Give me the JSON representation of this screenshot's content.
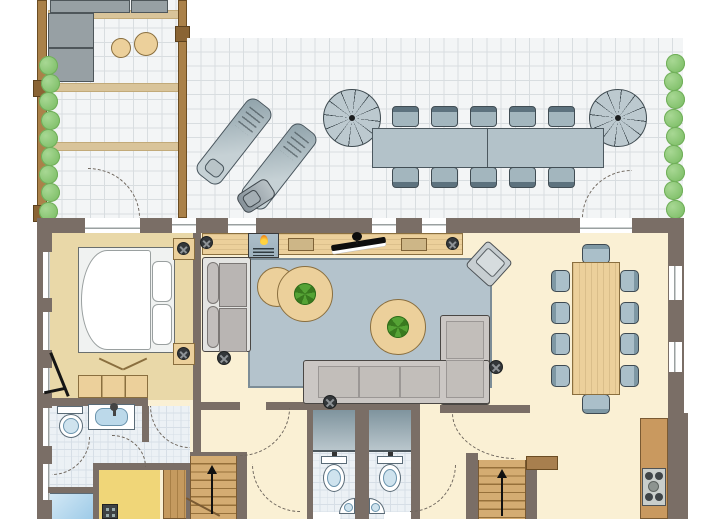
{
  "plan": {
    "type": "floor-plan",
    "view": "top-down",
    "text_labels": [],
    "levels_shown": 1
  },
  "palette": {
    "wall": "#7a6e66",
    "tile": "#f3f5f6",
    "tile_line": "#d8dde0",
    "floor_cream": "#faf0d4",
    "floor_bedroom": "#e9d8a8",
    "floor_bath": "#ecf1f5",
    "bath_line": "#d6dee6",
    "beam": "#d9c49a",
    "fence": "#aa8149",
    "fence_dark": "#6b4c22",
    "bush": "#84c26e",
    "wood": "#ecd09b",
    "wood_edge": "#8a6f3f",
    "rug": "#b4c3cc",
    "sofa": "#e4e4e2",
    "lsofa": "#cbc7c4",
    "outdoor": "#b3c2c9",
    "parasol": "#bcc9cf",
    "stairs": "#d4ac72",
    "counter": "#c9995f",
    "shower": "#9ecbe8",
    "sink": "#bcd9ea",
    "room_yellow": "#f0d678",
    "plant": "#4e9b30",
    "arc": "#6f675e"
  },
  "terrace": {
    "lounge_corner": {
      "corner_sofa": 1,
      "poufs": 2,
      "overhead_beams": 3
    },
    "main": {
      "sun_loungers": 2,
      "parasols": 2,
      "table_sections": 2,
      "chairs_per_side": 5,
      "bbq_grill": 1,
      "door_arcs": 2
    },
    "hedge_bushes_left": 9,
    "hedge_bushes_right": 9
  },
  "bedroom": {
    "double_bed": 1,
    "pillows": 2,
    "nightstands": 2,
    "lamps": 2,
    "wardrobe": 1,
    "leaning_object": 1
  },
  "living_room": {
    "sideboard": 1,
    "fireplace": 1,
    "tv": 1,
    "speakers": 2,
    "table_lamps": 2,
    "two_seat_sofa": 1,
    "corner_sofa": 1,
    "accent_chair": 1,
    "round_tables": 3,
    "plants": 2,
    "floor_lamps": 3,
    "rug": 1
  },
  "dining_room": {
    "table": 1,
    "side_chairs_per_side": 4,
    "end_chairs": 2
  },
  "bathroom": {
    "toilet": 1,
    "washbasin": 1,
    "door_arcs": 3
  },
  "wc_rooms": {
    "count": 2,
    "each": {
      "shower": 1,
      "toilet": 1,
      "corner_sink": 1
    }
  },
  "kitchen": {
    "counter": 1,
    "hob": 1,
    "hob_burners": 4
  },
  "stairs": {
    "count": 2,
    "direction": "up"
  },
  "utility": {
    "shower_tub": 1,
    "boiler": 1,
    "plank_closet": 1
  }
}
